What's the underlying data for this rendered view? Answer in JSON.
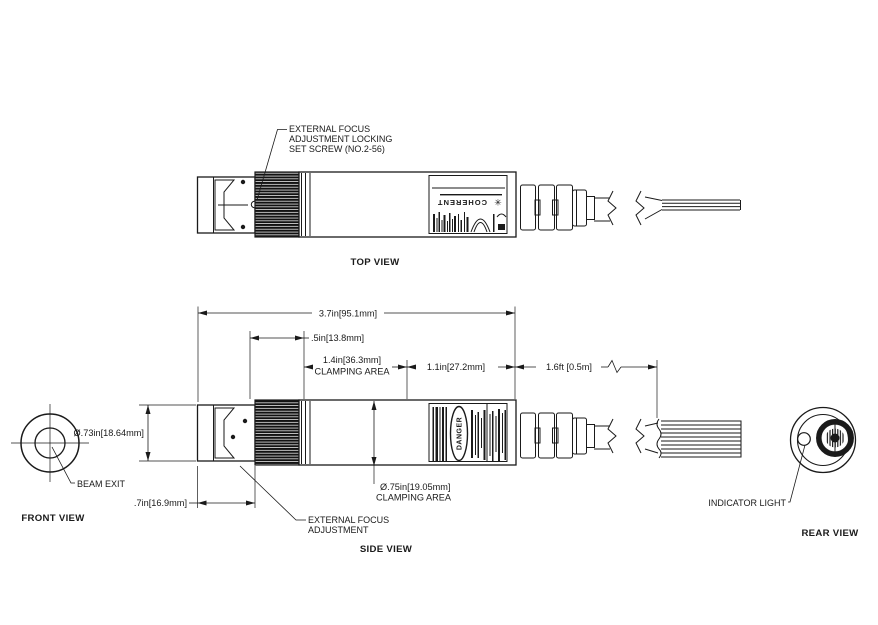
{
  "drawing": {
    "background": "#ffffff",
    "ink": "#1a1a1a",
    "views": {
      "top": {
        "label": "TOP VIEW"
      },
      "front": {
        "label": "FRONT VIEW"
      },
      "side": {
        "label": "SIDE VIEW"
      },
      "rear": {
        "label": "REAR VIEW"
      }
    },
    "callouts": {
      "set_screw_line1": "EXTERNAL FOCUS",
      "set_screw_line2": "ADJUSTMENT LOCKING",
      "set_screw_line3": "SET SCREW (NO.2-56)",
      "beam_exit": "BEAM EXIT",
      "focus_line1": "EXTERNAL FOCUS",
      "focus_line2": "ADJUSTMENT",
      "indicator_light": "INDICATOR LIGHT"
    },
    "dimensions": {
      "overall_length": "3.7in[95.1mm]",
      "focus_ring_length": ".5in[13.8mm]",
      "clamping_length_line1": "1.4in[36.3mm]",
      "clamping_length_line2": "CLAMPING AREA",
      "rear_section_length": "1.1in[27.2mm]",
      "cable_length": "1.6ft [0.5m]",
      "head_diameter": "Ø.73in[18.64mm]",
      "head_length": ".7in[16.9mm]",
      "clamping_diameter_line1": "Ø.75in[19.05mm]",
      "clamping_diameter_line2": "CLAMPING AREA"
    },
    "product_label": {
      "brand": "COHERENT",
      "warning": "DANGER"
    }
  }
}
